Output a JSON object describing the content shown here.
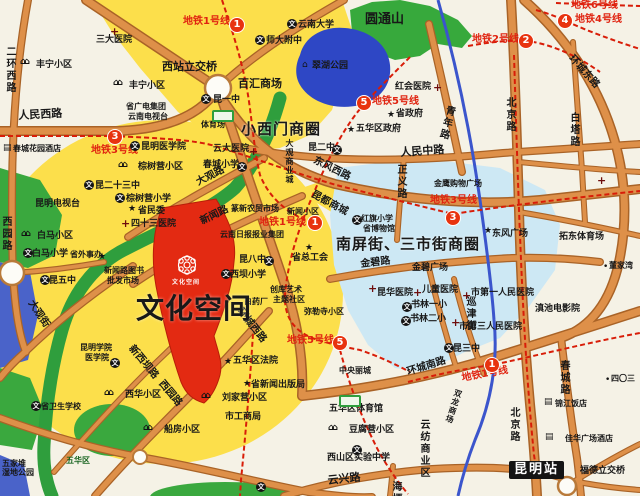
{
  "colors": {
    "background": "#f5f2e6",
    "yellow_zone": "#fcdf4b",
    "blue_zone": "#cde8f4",
    "lake": "#2e47c5",
    "park_green": "#3aa83e",
    "river_green": "#2f9e3d",
    "road_core": "#de9049",
    "road_casing": "#a96327",
    "metro_red": "#d81d08",
    "badge_red": "#e8330f",
    "river_blue": "#3b55cc",
    "site_red": "#e32a12",
    "station_bg": "#141414"
  },
  "icon_glyphs": {
    "school": "文",
    "hosp": "+",
    "star": "★",
    "house": "⌂⌂",
    "bldg": "▤",
    "dot": "•",
    "pav": "⌂"
  },
  "badges": [
    {
      "line": "1",
      "x": 230,
      "y": 18
    },
    {
      "line": "3",
      "x": 108,
      "y": 130
    },
    {
      "line": "5",
      "x": 357,
      "y": 96
    },
    {
      "line": "2",
      "x": 519,
      "y": 34
    },
    {
      "line": "4",
      "x": 558,
      "y": 14
    },
    {
      "line": "1",
      "x": 308,
      "y": 216
    },
    {
      "line": "3",
      "x": 446,
      "y": 211
    },
    {
      "line": "5",
      "x": 333,
      "y": 336
    },
    {
      "line": "1",
      "x": 485,
      "y": 358
    }
  ],
  "icons": [
    {
      "t": "hosp",
      "x": 110,
      "y": 26
    },
    {
      "t": "house",
      "x": 20,
      "y": 58
    },
    {
      "t": "house",
      "x": 113,
      "y": 79
    },
    {
      "t": "school",
      "x": 201,
      "y": 94
    },
    {
      "t": "school",
      "x": 287,
      "y": 19
    },
    {
      "t": "school",
      "x": 255,
      "y": 35
    },
    {
      "t": "pav",
      "x": 302,
      "y": 61
    },
    {
      "t": "hosp",
      "x": 433,
      "y": 82
    },
    {
      "t": "bldg",
      "x": 3,
      "y": 144
    },
    {
      "t": "school",
      "x": 130,
      "y": 141
    },
    {
      "t": "house",
      "x": 118,
      "y": 161
    },
    {
      "t": "school",
      "x": 84,
      "y": 180
    },
    {
      "t": "school",
      "x": 115,
      "y": 193
    },
    {
      "t": "star",
      "x": 128,
      "y": 205
    },
    {
      "t": "hosp",
      "x": 121,
      "y": 218
    },
    {
      "t": "house",
      "x": 21,
      "y": 230
    },
    {
      "t": "school",
      "x": 23,
      "y": 248
    },
    {
      "t": "star",
      "x": 98,
      "y": 253
    },
    {
      "t": "school",
      "x": 40,
      "y": 275
    },
    {
      "t": "hosp",
      "x": 249,
      "y": 146
    },
    {
      "t": "school",
      "x": 237,
      "y": 162
    },
    {
      "t": "school",
      "x": 332,
      "y": 145
    },
    {
      "t": "star",
      "x": 347,
      "y": 126
    },
    {
      "t": "star",
      "x": 387,
      "y": 111
    },
    {
      "t": "school",
      "x": 352,
      "y": 215
    },
    {
      "t": "school",
      "x": 264,
      "y": 256
    },
    {
      "t": "star",
      "x": 305,
      "y": 244
    },
    {
      "t": "school",
      "x": 221,
      "y": 269
    },
    {
      "t": "school",
      "x": 110,
      "y": 358
    },
    {
      "t": "school",
      "x": 31,
      "y": 401
    },
    {
      "t": "house",
      "x": 104,
      "y": 389
    },
    {
      "t": "house",
      "x": 143,
      "y": 424
    },
    {
      "t": "house",
      "x": 201,
      "y": 392
    },
    {
      "t": "star",
      "x": 224,
      "y": 358
    },
    {
      "t": "star",
      "x": 243,
      "y": 380
    },
    {
      "t": "house",
      "x": 328,
      "y": 424
    },
    {
      "t": "school",
      "x": 352,
      "y": 445
    },
    {
      "t": "school",
      "x": 256,
      "y": 482
    },
    {
      "t": "school",
      "x": 444,
      "y": 343
    },
    {
      "t": "hosp",
      "x": 368,
      "y": 283
    },
    {
      "t": "hosp",
      "x": 413,
      "y": 287
    },
    {
      "t": "hosp",
      "x": 462,
      "y": 290
    },
    {
      "t": "hosp",
      "x": 451,
      "y": 317
    },
    {
      "t": "school",
      "x": 402,
      "y": 302
    },
    {
      "t": "school",
      "x": 401,
      "y": 316
    },
    {
      "t": "star",
      "x": 484,
      "y": 227
    },
    {
      "t": "dot",
      "x": 603,
      "y": 263
    },
    {
      "t": "dot",
      "x": 605,
      "y": 376
    },
    {
      "t": "bldg",
      "x": 544,
      "y": 398
    },
    {
      "t": "bldg",
      "x": 545,
      "y": 433
    },
    {
      "t": "hosp",
      "x": 597,
      "y": 175
    },
    {
      "t": "stad",
      "x": 212,
      "y": 110
    },
    {
      "t": "stad",
      "x": 339,
      "y": 395
    }
  ],
  "labels": [
    {
      "t": "二环西路",
      "x": 4,
      "y": 46,
      "c": "road-v"
    },
    {
      "t": "人民西路",
      "x": 18,
      "y": 110,
      "c": "road-lg",
      "r": -3
    },
    {
      "t": "三大医院",
      "x": 96,
      "y": 36,
      "c": "poi"
    },
    {
      "t": "丰宁小区",
      "x": 36,
      "y": 61,
      "c": "poi"
    },
    {
      "t": "丰宁小区",
      "x": 129,
      "y": 82,
      "c": "poi"
    },
    {
      "t": "地铁1号线",
      "x": 183,
      "y": 17,
      "c": "metro"
    },
    {
      "t": "西站立交桥",
      "x": 162,
      "y": 61,
      "c": "road-lg"
    },
    {
      "t": "百汇商场",
      "x": 238,
      "y": 78,
      "c": "road-lg"
    },
    {
      "t": "昆一中",
      "x": 213,
      "y": 96,
      "c": "poi"
    },
    {
      "t": "体育场",
      "x": 201,
      "y": 121,
      "c": "poi-sm"
    },
    {
      "t": "云南大学",
      "x": 298,
      "y": 21,
      "c": "poi"
    },
    {
      "t": "师大附中",
      "x": 266,
      "y": 37,
      "c": "poi"
    },
    {
      "t": "圆通山",
      "x": 365,
      "y": 13,
      "c": "green-title"
    },
    {
      "t": "翠湖公园",
      "x": 312,
      "y": 62,
      "c": "poi"
    },
    {
      "t": "红会医院",
      "x": 395,
      "y": 83,
      "c": "poi"
    },
    {
      "t": "地铁5号线",
      "x": 372,
      "y": 97,
      "c": "metro"
    },
    {
      "t": "地铁2号线",
      "x": 472,
      "y": 35,
      "c": "metro"
    },
    {
      "t": "地铁4号线",
      "x": 575,
      "y": 15,
      "c": "metro"
    },
    {
      "t": "地铁6号线",
      "x": 571,
      "y": 1,
      "c": "metro"
    },
    {
      "t": "环城东路",
      "x": 574,
      "y": 54,
      "c": "road",
      "r": 48
    },
    {
      "t": "白塔路",
      "x": 568,
      "y": 112,
      "c": "road-v"
    },
    {
      "t": "北京路",
      "x": 504,
      "y": 97,
      "c": "road-v"
    },
    {
      "t": "青年路",
      "x": 445,
      "y": 104,
      "c": "road-v",
      "r": 14
    },
    {
      "t": "人民中路",
      "x": 400,
      "y": 147,
      "c": "road-lg",
      "r": -4
    },
    {
      "t": "正义路",
      "x": 395,
      "y": 164,
      "c": "road-v"
    },
    {
      "t": "金鹰购物广场",
      "x": 434,
      "y": 180,
      "c": "poi-sm"
    },
    {
      "t": "地铁3号线",
      "x": 430,
      "y": 196,
      "c": "metro"
    },
    {
      "t": "五华区政府",
      "x": 356,
      "y": 125,
      "c": "poi"
    },
    {
      "t": "省政府",
      "x": 396,
      "y": 110,
      "c": "poi"
    },
    {
      "t": "小西门商圈",
      "x": 241,
      "y": 122,
      "c": "big"
    },
    {
      "t": "云大医院",
      "x": 213,
      "y": 145,
      "c": "poi"
    },
    {
      "t": "春城小学",
      "x": 203,
      "y": 161,
      "c": "poi"
    },
    {
      "t": "昆二中",
      "x": 308,
      "y": 144,
      "c": "poi"
    },
    {
      "t": "东风西路",
      "x": 316,
      "y": 156,
      "c": "road",
      "r": 26
    },
    {
      "t": "昆都商城",
      "x": 314,
      "y": 190,
      "c": "road",
      "r": 28
    },
    {
      "t": "红旗小学",
      "x": 361,
      "y": 215,
      "c": "poi-sm"
    },
    {
      "t": "省博物馆",
      "x": 363,
      "y": 225,
      "c": "poi-sm"
    },
    {
      "t": "南屏街、三市街商圈",
      "x": 336,
      "y": 237,
      "c": "big"
    },
    {
      "t": "地铁3号线",
      "x": 91,
      "y": 146,
      "c": "metro"
    },
    {
      "t": "地铁5号线",
      "x": 287,
      "y": 336,
      "c": "metro"
    },
    {
      "t": "春城花园酒店",
      "x": 13,
      "y": 145,
      "c": "poi-sm"
    },
    {
      "t": "省广电集团",
      "x": 126,
      "y": 103,
      "c": "poi-sm"
    },
    {
      "t": "云南电视台",
      "x": 128,
      "y": 113,
      "c": "poi-sm"
    },
    {
      "t": "昆明医学院",
      "x": 141,
      "y": 143,
      "c": "poi"
    },
    {
      "t": "棕树营小区",
      "x": 138,
      "y": 163,
      "c": "poi"
    },
    {
      "t": "昆二十三中",
      "x": 95,
      "y": 182,
      "c": "poi"
    },
    {
      "t": "棕树营小学",
      "x": 126,
      "y": 195,
      "c": "poi"
    },
    {
      "t": "省民委",
      "x": 138,
      "y": 207,
      "c": "poi"
    },
    {
      "t": "四十三医院",
      "x": 131,
      "y": 220,
      "c": "poi"
    },
    {
      "t": "大观路",
      "x": 195,
      "y": 179,
      "c": "road",
      "r": -27
    },
    {
      "t": "新闻路",
      "x": 199,
      "y": 218,
      "c": "road",
      "r": -26
    },
    {
      "t": "昆明电视台",
      "x": 35,
      "y": 200,
      "c": "poi"
    },
    {
      "t": "白马小区",
      "x": 37,
      "y": 232,
      "c": "poi"
    },
    {
      "t": "白马小学",
      "x": 32,
      "y": 250,
      "c": "poi"
    },
    {
      "t": "省外事办",
      "x": 70,
      "y": 251,
      "c": "poi-sm"
    },
    {
      "t": "昆五中",
      "x": 49,
      "y": 277,
      "c": "poi"
    },
    {
      "t": "新闻路图书",
      "x": 104,
      "y": 267,
      "c": "poi-sm"
    },
    {
      "t": "批发市场",
      "x": 107,
      "y": 277,
      "c": "poi-sm"
    },
    {
      "t": "西园路",
      "x": 0,
      "y": 216,
      "c": "road-v"
    },
    {
      "t": "大观街",
      "x": 34,
      "y": 299,
      "c": "road",
      "r": 56
    },
    {
      "t": "篆新农贸市场",
      "x": 231,
      "y": 205,
      "c": "poi-sm"
    },
    {
      "t": "新闻小区",
      "x": 287,
      "y": 208,
      "c": "poi-sm"
    },
    {
      "t": "地铁1号线",
      "x": 259,
      "y": 218,
      "c": "metro"
    },
    {
      "t": "云南日报报业集团",
      "x": 220,
      "y": 231,
      "c": "poi-sm"
    },
    {
      "t": "昆八中",
      "x": 239,
      "y": 256,
      "c": "poi"
    },
    {
      "t": "省总工会",
      "x": 292,
      "y": 254,
      "c": "poi"
    },
    {
      "t": "西坝小学",
      "x": 230,
      "y": 271,
      "c": "poi"
    },
    {
      "t": "创库艺术",
      "x": 270,
      "y": 286,
      "c": "poi-sm"
    },
    {
      "t": "主题社区",
      "x": 273,
      "y": 296,
      "c": "poi-sm"
    },
    {
      "t": "白药厂",
      "x": 244,
      "y": 298,
      "c": "poi-sm"
    },
    {
      "t": "弥勒寺小区",
      "x": 304,
      "y": 308,
      "c": "poi-sm"
    },
    {
      "t": "大观商业城",
      "x": 285,
      "y": 139,
      "c": "v-sm"
    },
    {
      "t": "环城西路",
      "x": 243,
      "y": 307,
      "c": "road",
      "r": 52
    },
    {
      "t": "文化空间",
      "x": 136,
      "y": 295,
      "c": "huge"
    },
    {
      "t": "文化空间",
      "x": 172,
      "y": 280,
      "c": "logo-text"
    },
    {
      "t": "新西坝路",
      "x": 134,
      "y": 344,
      "c": "road",
      "r": 50
    },
    {
      "t": "西园路",
      "x": 164,
      "y": 379,
      "c": "road",
      "r": 50
    },
    {
      "t": "昆明学院",
      "x": 80,
      "y": 344,
      "c": "poi-sm"
    },
    {
      "t": "医学院",
      "x": 85,
      "y": 354,
      "c": "poi-sm"
    },
    {
      "t": "省卫生学校",
      "x": 41,
      "y": 403,
      "c": "poi-sm"
    },
    {
      "t": "西华小区",
      "x": 125,
      "y": 391,
      "c": "poi"
    },
    {
      "t": "船房小区",
      "x": 164,
      "y": 426,
      "c": "poi"
    },
    {
      "t": "五家堆",
      "x": 2,
      "y": 460,
      "c": "poi-sm"
    },
    {
      "t": "湿地公园",
      "x": 2,
      "y": 469,
      "c": "poi-sm"
    },
    {
      "t": "五华区",
      "x": 66,
      "y": 457,
      "c": "green-sm"
    },
    {
      "t": "五华区法院",
      "x": 233,
      "y": 357,
      "c": "poi"
    },
    {
      "t": "省新闻出版局",
      "x": 251,
      "y": 381,
      "c": "poi"
    },
    {
      "t": "刘家营小区",
      "x": 222,
      "y": 394,
      "c": "poi"
    },
    {
      "t": "市工商局",
      "x": 225,
      "y": 413,
      "c": "poi"
    },
    {
      "t": "中央丽城",
      "x": 339,
      "y": 367,
      "c": "poi-sm"
    },
    {
      "t": "五华区体育馆",
      "x": 329,
      "y": 405,
      "c": "poi"
    },
    {
      "t": "豆腐营小区",
      "x": 349,
      "y": 426,
      "c": "poi"
    },
    {
      "t": "西山区实验中学",
      "x": 327,
      "y": 454,
      "c": "poi"
    },
    {
      "t": "云兴路",
      "x": 327,
      "y": 475,
      "c": "road-lg",
      "r": -6
    },
    {
      "t": "云纺商业区",
      "x": 418,
      "y": 419,
      "c": "road-v"
    },
    {
      "t": "海埂路",
      "x": 390,
      "y": 481,
      "c": "road-v"
    },
    {
      "t": "环城南路",
      "x": 406,
      "y": 368,
      "c": "road",
      "r": -17
    },
    {
      "t": "地铁1号线",
      "x": 461,
      "y": 374,
      "c": "metro",
      "r": -10
    },
    {
      "t": "昆三中",
      "x": 453,
      "y": 345,
      "c": "poi"
    },
    {
      "t": "双龙商场",
      "x": 455,
      "y": 388,
      "c": "v-sm",
      "r": 18
    },
    {
      "t": "北京路",
      "x": 508,
      "y": 407,
      "c": "road-v"
    },
    {
      "t": "春城路",
      "x": 558,
      "y": 360,
      "c": "road-v"
    },
    {
      "t": "锦江饭店",
      "x": 555,
      "y": 400,
      "c": "poi-sm"
    },
    {
      "t": "佳华广场酒店",
      "x": 565,
      "y": 435,
      "c": "poi-sm"
    },
    {
      "t": "昆明站",
      "x": 509,
      "y": 461,
      "c": "station"
    },
    {
      "t": "福德立交桥",
      "x": 580,
      "y": 467,
      "c": "poi"
    },
    {
      "t": "四〇三",
      "x": 611,
      "y": 375,
      "c": "poi-sm"
    },
    {
      "t": "金碧路",
      "x": 360,
      "y": 260,
      "c": "road",
      "r": -7
    },
    {
      "t": "金碧广场",
      "x": 412,
      "y": 264,
      "c": "poi"
    },
    {
      "t": "昆华医院",
      "x": 377,
      "y": 289,
      "c": "poi"
    },
    {
      "t": "儿童医院",
      "x": 422,
      "y": 286,
      "c": "poi"
    },
    {
      "t": "市第一人民医院",
      "x": 471,
      "y": 289,
      "c": "poi"
    },
    {
      "t": "书林一小",
      "x": 411,
      "y": 301,
      "c": "poi"
    },
    {
      "t": "书林二小",
      "x": 410,
      "y": 315,
      "c": "poi"
    },
    {
      "t": "巡津街",
      "x": 464,
      "y": 296,
      "c": "road-v"
    },
    {
      "t": "市第三人民医院",
      "x": 459,
      "y": 323,
      "c": "poi"
    },
    {
      "t": "滇池电影院",
      "x": 535,
      "y": 305,
      "c": "poi"
    },
    {
      "t": "东风广场",
      "x": 492,
      "y": 230,
      "c": "poi"
    },
    {
      "t": "拓东体育场",
      "x": 559,
      "y": 233,
      "c": "poi"
    },
    {
      "t": "董家湾",
      "x": 609,
      "y": 262,
      "c": "poi-sm"
    }
  ]
}
